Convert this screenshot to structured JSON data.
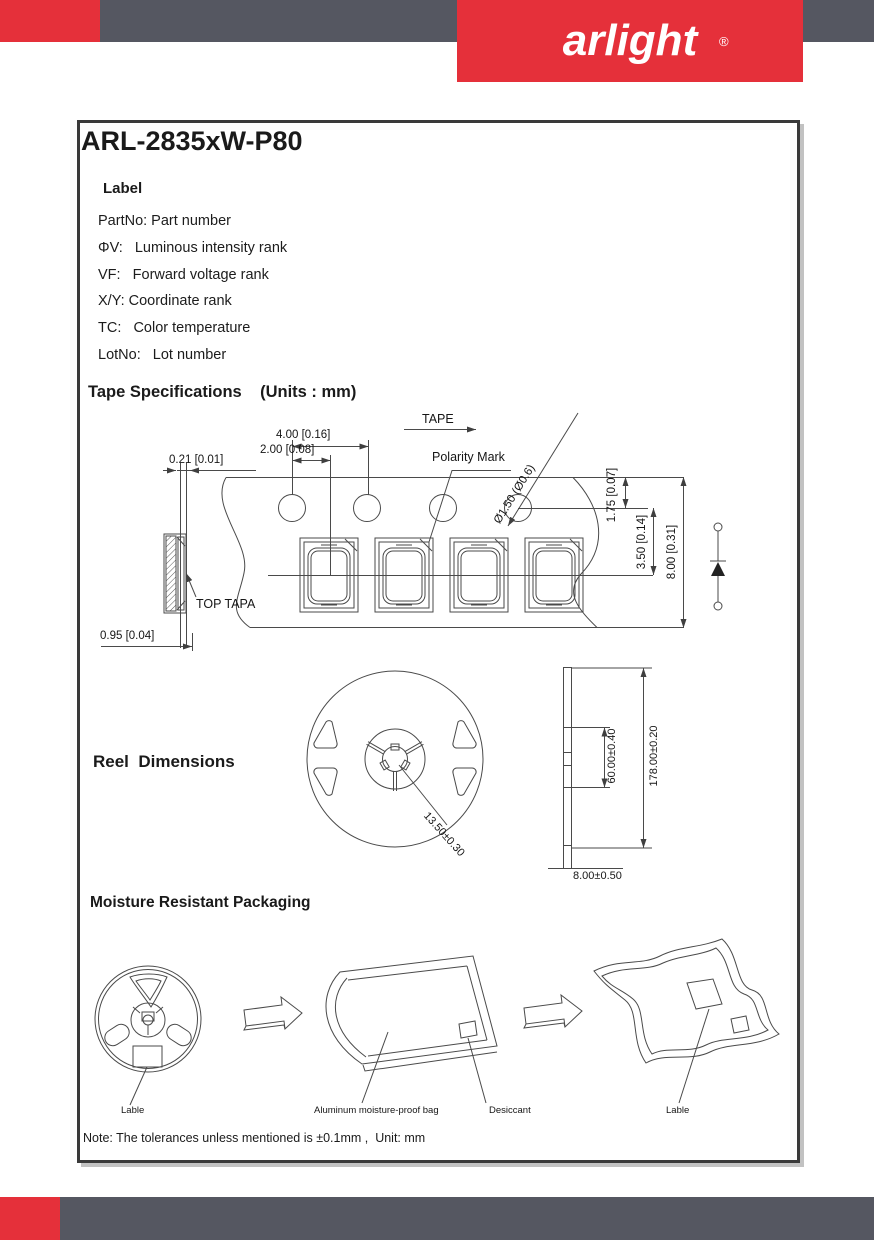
{
  "header": {
    "logo": "arlight",
    "registered": "®",
    "brand_red": "#e5303a",
    "band_gray": "#555761"
  },
  "page": {
    "title": "ARL-2835xW-P80",
    "label_section": {
      "heading": "Label",
      "items": [
        "PartNo: Part number",
        "ΦV:   Luminous intensity rank",
        "VF:   Forward voltage rank",
        "X/Y: Coordinate rank",
        "TC:   Color temperature",
        "LotNo:   Lot number"
      ]
    },
    "tape_section": {
      "heading": "Tape Specifications    (Units : mm)",
      "tape_label": "TAPE",
      "polarity_mark": "Polarity Mark",
      "top_tapa": "TOP TAPA",
      "dims": {
        "pitch_4": "4.00 [0.16]",
        "pitch_2": "2.00 [0.08]",
        "thickness": "0.21 [0.01]",
        "hole_dia": "Ø1.50 (Ø0.6)",
        "d_175": "1.75 [0.07]",
        "d_350": "3.50 [0.14]",
        "d_800": "8.00 [0.31]",
        "d_095": "0.95 [0.04]"
      }
    },
    "reel_section": {
      "heading": "Reel  Dimensions",
      "dims": {
        "hub": "13.50±0.30",
        "inner_width": "60.00±0.40",
        "diameter": "178.00±0.20",
        "width": "8.00±0.50"
      }
    },
    "packaging_section": {
      "heading": "Moisture Resistant Packaging",
      "reel_label": "Lable",
      "bag_label": "Aluminum moisture-proof bag",
      "desiccant_label": "Desiccant",
      "sealed_bag_label": "Lable"
    },
    "note": "Note: The tolerances unless mentioned is ±0.1mm ,  Unit: mm"
  }
}
